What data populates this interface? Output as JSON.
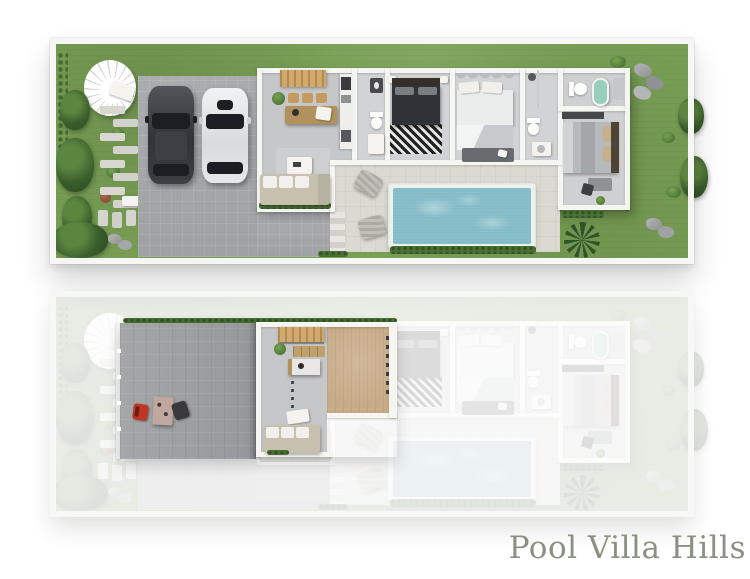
{
  "brand": {
    "label": "Pool Villa Hills",
    "color": "#8b9181"
  },
  "palette": {
    "background": "#ffffff",
    "grass": "#79a055",
    "tree_green": "#3a5e2c",
    "wall_white": "#f5f5f2",
    "driveway": "#a6a8aa",
    "roof_terrace": "#9da0a2",
    "patio": "#dcd9d3",
    "pool_water": "#85bcc8",
    "pool_rim": "#eef0ec",
    "wood_deck": "#c8ac88",
    "stairs_wood": "#c19a5f",
    "sofa_beige": "#c7c0ae",
    "bed_dark": "#2f3236",
    "bed_light": "#ebecec",
    "bathtub_green": "#99cdbd",
    "accent_red_chair": "#c13526",
    "car_dark": "#303337",
    "car_white": "#f0f2f3"
  },
  "plans": {
    "ground": {
      "name": "ground-floor-plan",
      "rooms": [
        "garden",
        "spiral-staircase",
        "stepping-stones",
        "carport",
        "living-kitchen",
        "hall-bathroom",
        "bedroom-1",
        "bedroom-2",
        "shower-room",
        "wc-bathroom",
        "bedroom-3",
        "pool-patio",
        "swimming-pool"
      ],
      "vehicles": [
        "dark-suv",
        "white-sedan"
      ]
    },
    "upper": {
      "name": "upper-floor-plan",
      "style": "faded-except-highlights",
      "highlighted": [
        "roof-terrace",
        "outdoor-dining-set",
        "red-chair",
        "living-kitchen",
        "wood-deck"
      ]
    }
  }
}
